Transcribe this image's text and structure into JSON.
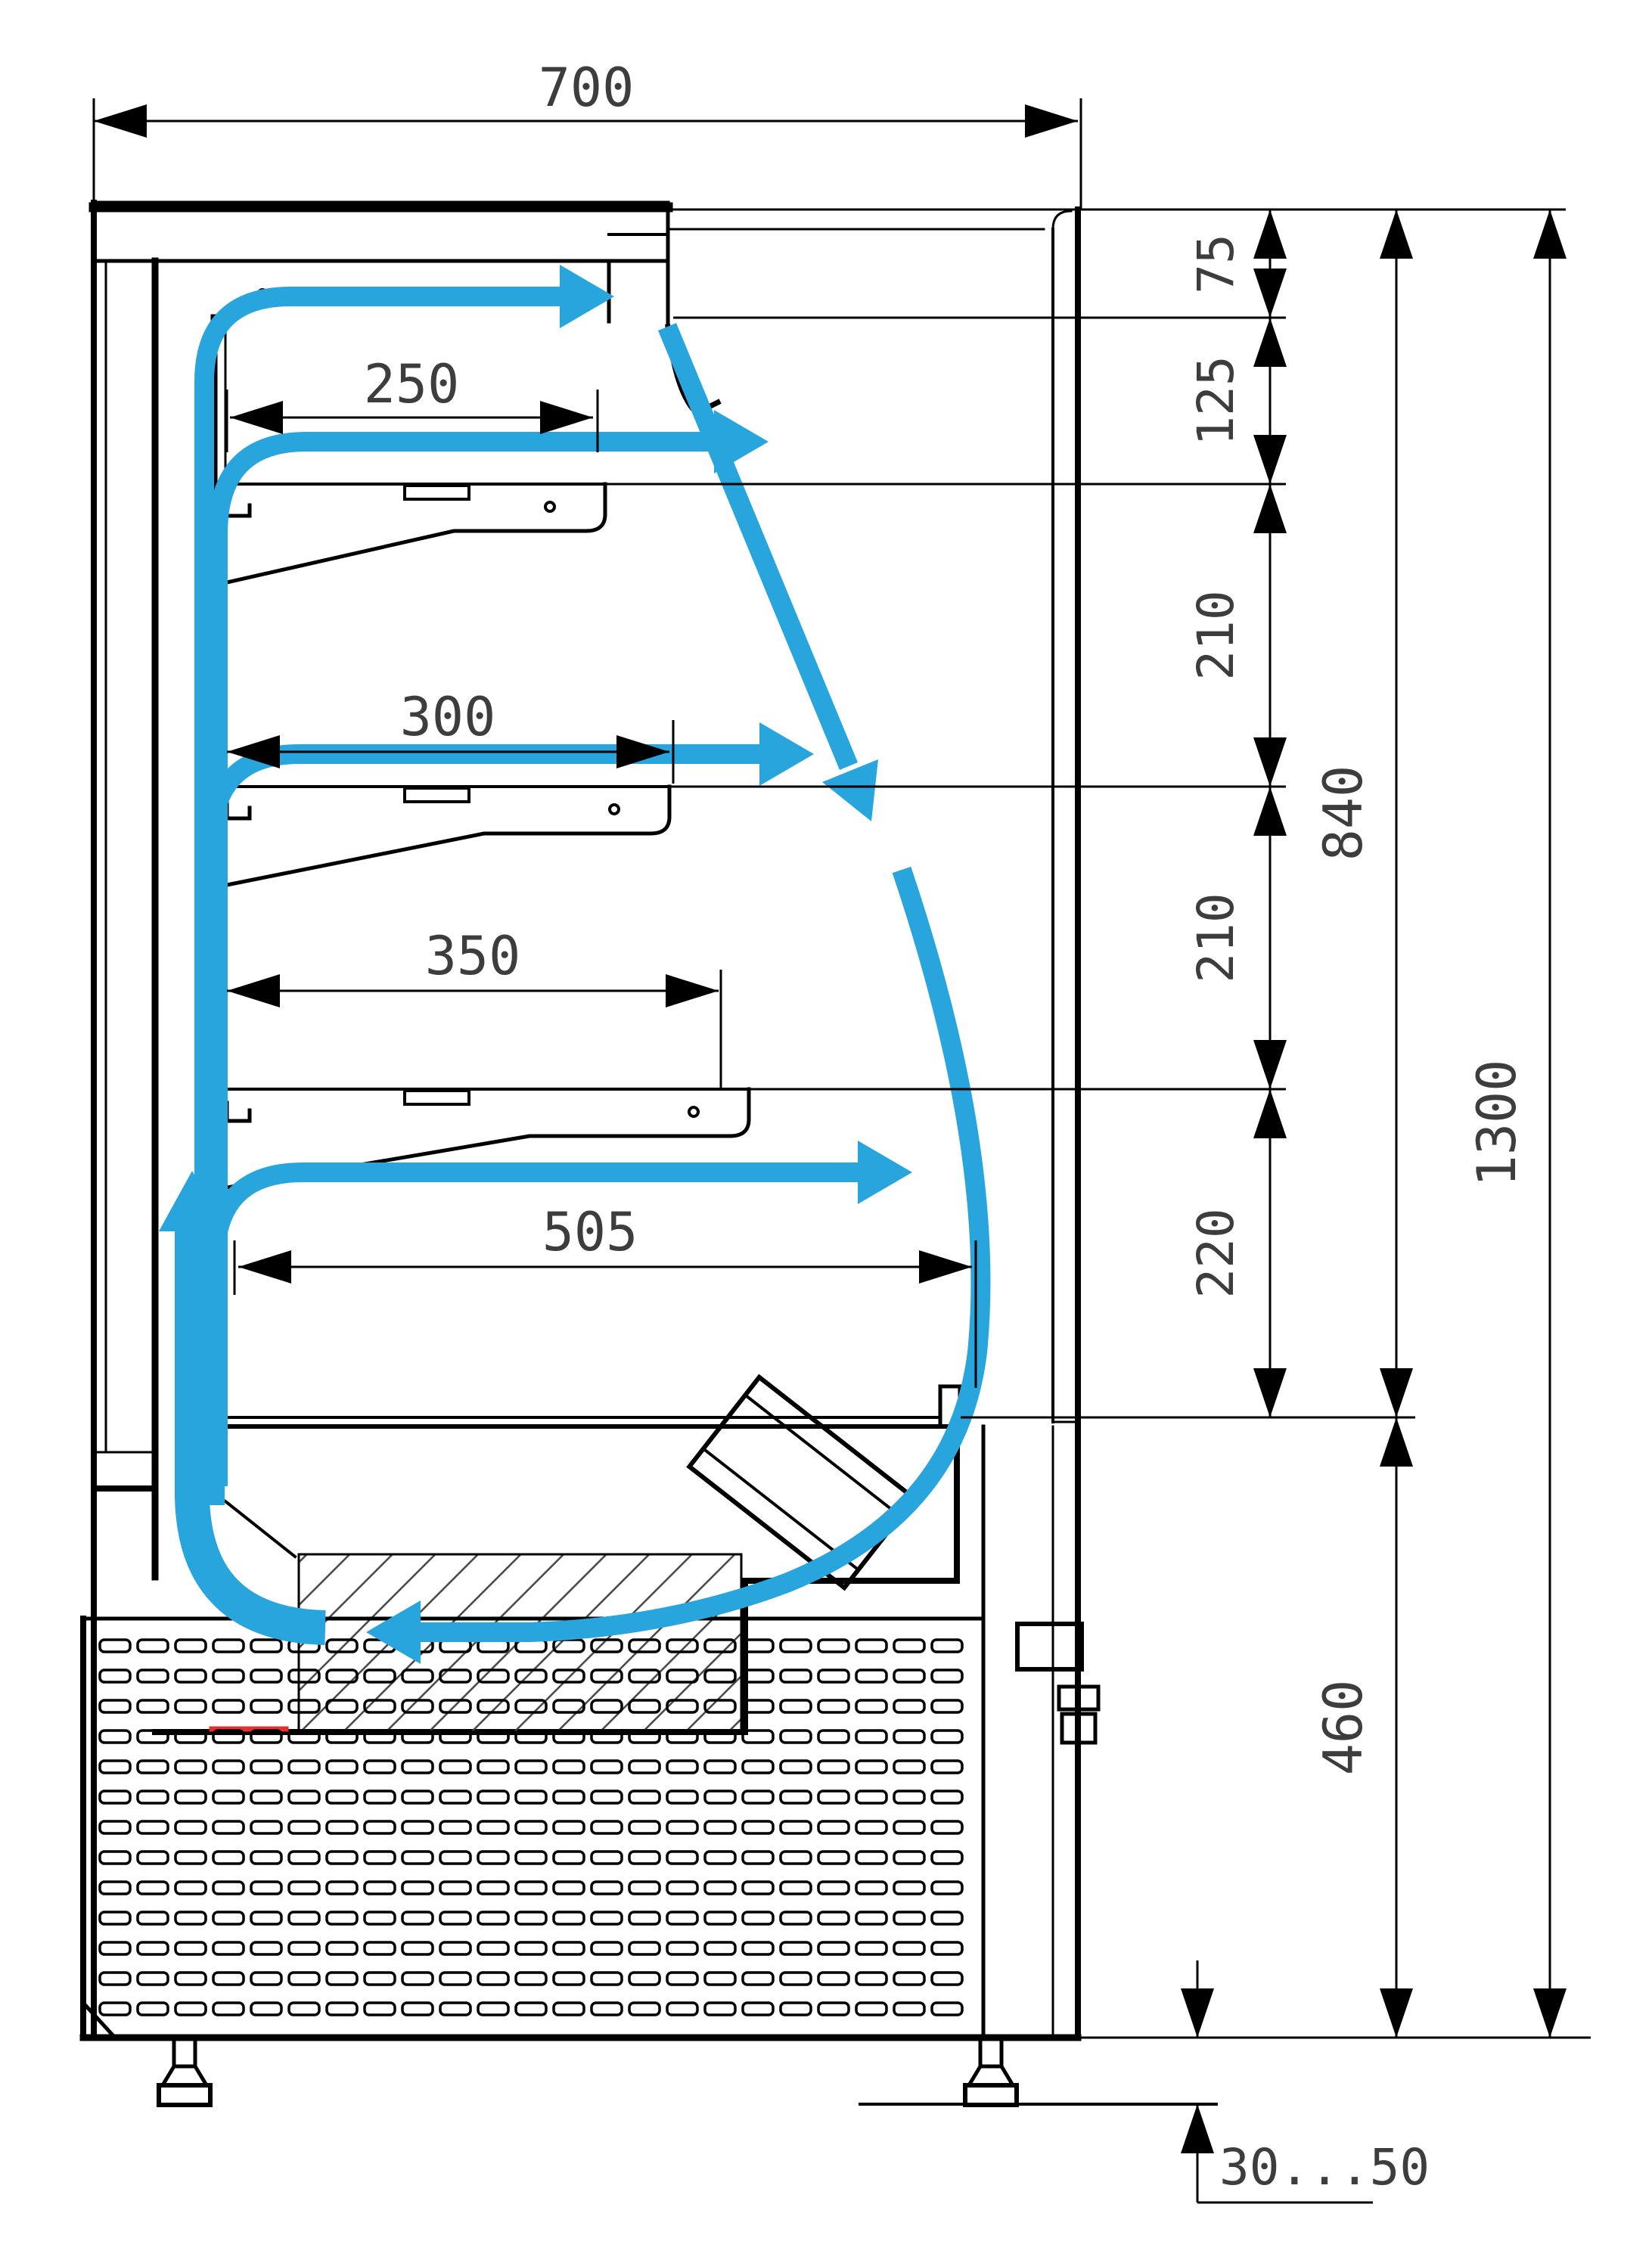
{
  "drawing": {
    "type": "technical-cross-section",
    "subject": "Open refrigerated display case - side section with air circulation arrows",
    "units": "mm",
    "colors": {
      "airflow_accent": "#29A5DE",
      "line": "#000000",
      "dimension_text": "#3d3d3d",
      "heater_element": "#e03030",
      "background": "#ffffff"
    },
    "dimensions": {
      "overall_depth": "700",
      "canopy_height": "75",
      "canopy_to_shelf1": "125",
      "shelf1_to_shelf2": "210",
      "shelf2_to_shelf3": "210",
      "shelf3_to_deck": "220",
      "display_opening_height": "840",
      "overall_height": "1300",
      "base_height": "460",
      "shelf1_depth": "250",
      "shelf2_depth": "300",
      "shelf3_depth": "350",
      "deck_depth": "505",
      "foot_adjust_range": "30...50"
    }
  }
}
